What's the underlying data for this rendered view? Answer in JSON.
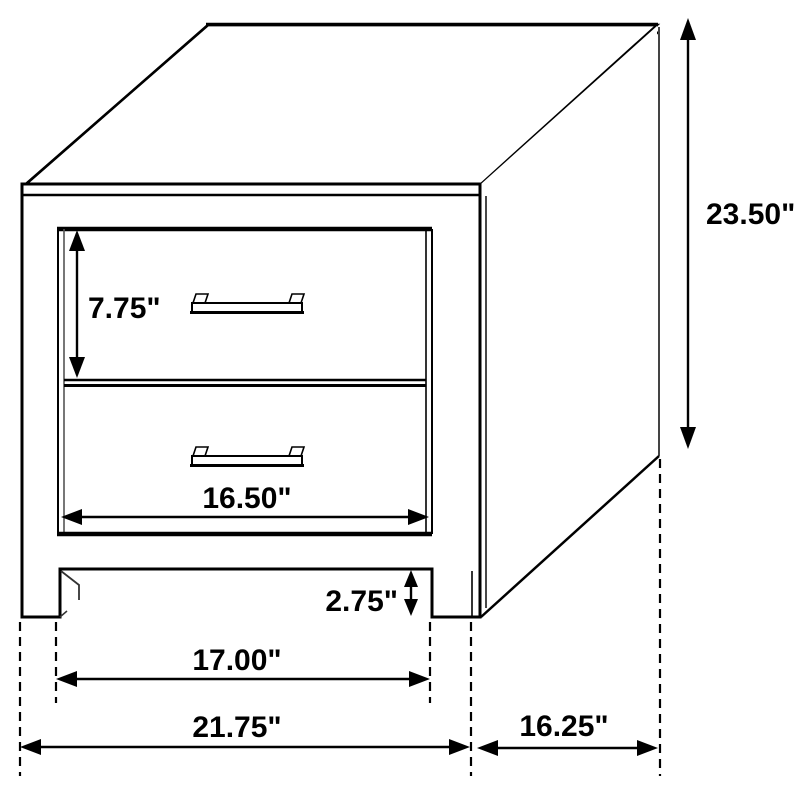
{
  "figure": {
    "kind": "furniture-dimension-diagram",
    "subject": "two-drawer nightstand, three-quarter line view",
    "background_color": "#ffffff",
    "line_color": "#000000"
  },
  "dims": {
    "drawer_height": {
      "label": "7.75\""
    },
    "drawer_width": {
      "label": "16.50\""
    },
    "leg_clearance": {
      "label": "2.75\""
    },
    "inner_width": {
      "label": "17.00\""
    },
    "overall_width": {
      "label": "21.75\""
    },
    "overall_depth": {
      "label": "16.25\""
    },
    "overall_height": {
      "label": "23.50\""
    }
  }
}
